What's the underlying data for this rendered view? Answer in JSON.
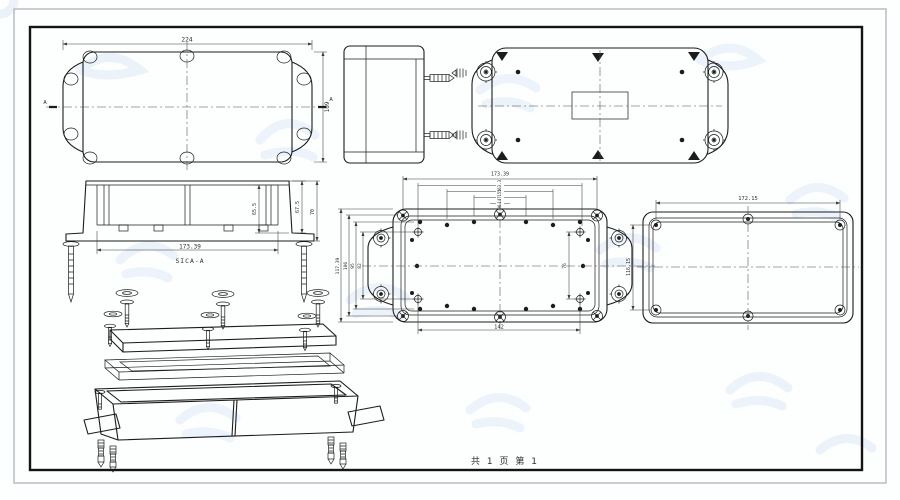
{
  "sheet": {
    "page_note": "共 1 页  第 1"
  },
  "views": {
    "lid_top": {
      "dim_width": "224",
      "dim_height": "109",
      "section_mark_left": "A",
      "section_mark_right": "A"
    },
    "section": {
      "label": "SICA-A",
      "dim_width": "173.39",
      "dim_h_inner": "65.5",
      "dim_h_mid": "67.5",
      "dim_h_outer": "70"
    },
    "base_inside": {
      "dim_top_outer": "173.39",
      "dim_top_nested": [
        "163.3",
        "155",
        "147",
        "96"
      ],
      "dim_left": [
        "117.39",
        "106",
        "95",
        "82"
      ],
      "dim_bottom": "142",
      "dim_inner_right": "76"
    },
    "lid_inside": {
      "dim_width": "172.15",
      "dim_height": "116.15"
    }
  },
  "colors": {
    "line": "#1c1c1c",
    "dimension": "#3c3c3c",
    "watermark_blue": "#dce8f6",
    "border_outer": "#b4b8bf",
    "border_inner": "#141414",
    "background": "#fdfefe"
  }
}
